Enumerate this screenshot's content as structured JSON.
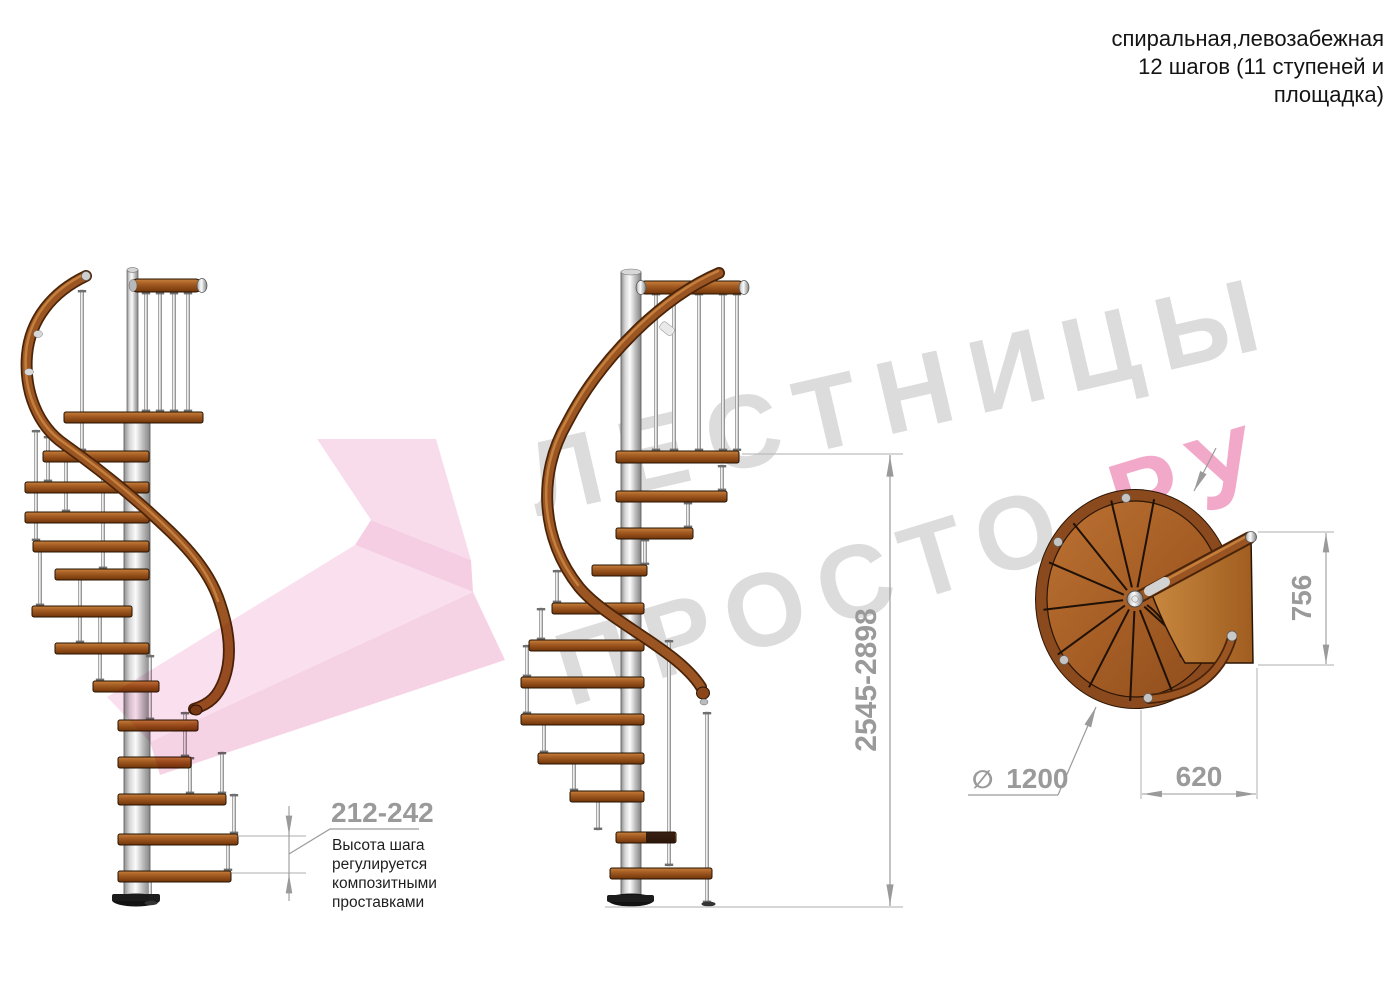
{
  "header": {
    "lines": [
      "спиральная,левозабежная",
      "12 шагов (11 ступеней и",
      "площадка)"
    ]
  },
  "watermark": {
    "line1": "ЛЕСТНИЦЫ",
    "line2_gray": "ПРОСТО",
    "line2_pink": ".РУ"
  },
  "dimensions": {
    "step_height": "212-242",
    "step_height_note": [
      "Высота шага",
      "регулируется",
      "композитными",
      "проставками"
    ],
    "total_height": "2545-2898",
    "plan_depth": "756",
    "plan_width": "620",
    "diameter_symbol": "∅",
    "diameter": "1200"
  },
  "colors": {
    "dimension": "#9a9a9a",
    "note_text": "#1f1f1f",
    "header_text": "#141414",
    "watermark_gray": "#dcdcdc",
    "watermark_pink": "#f2a8c8",
    "arrow_pink": "#f7d0e6",
    "wood": "#a75f24",
    "metal": "#c9c9c9"
  }
}
